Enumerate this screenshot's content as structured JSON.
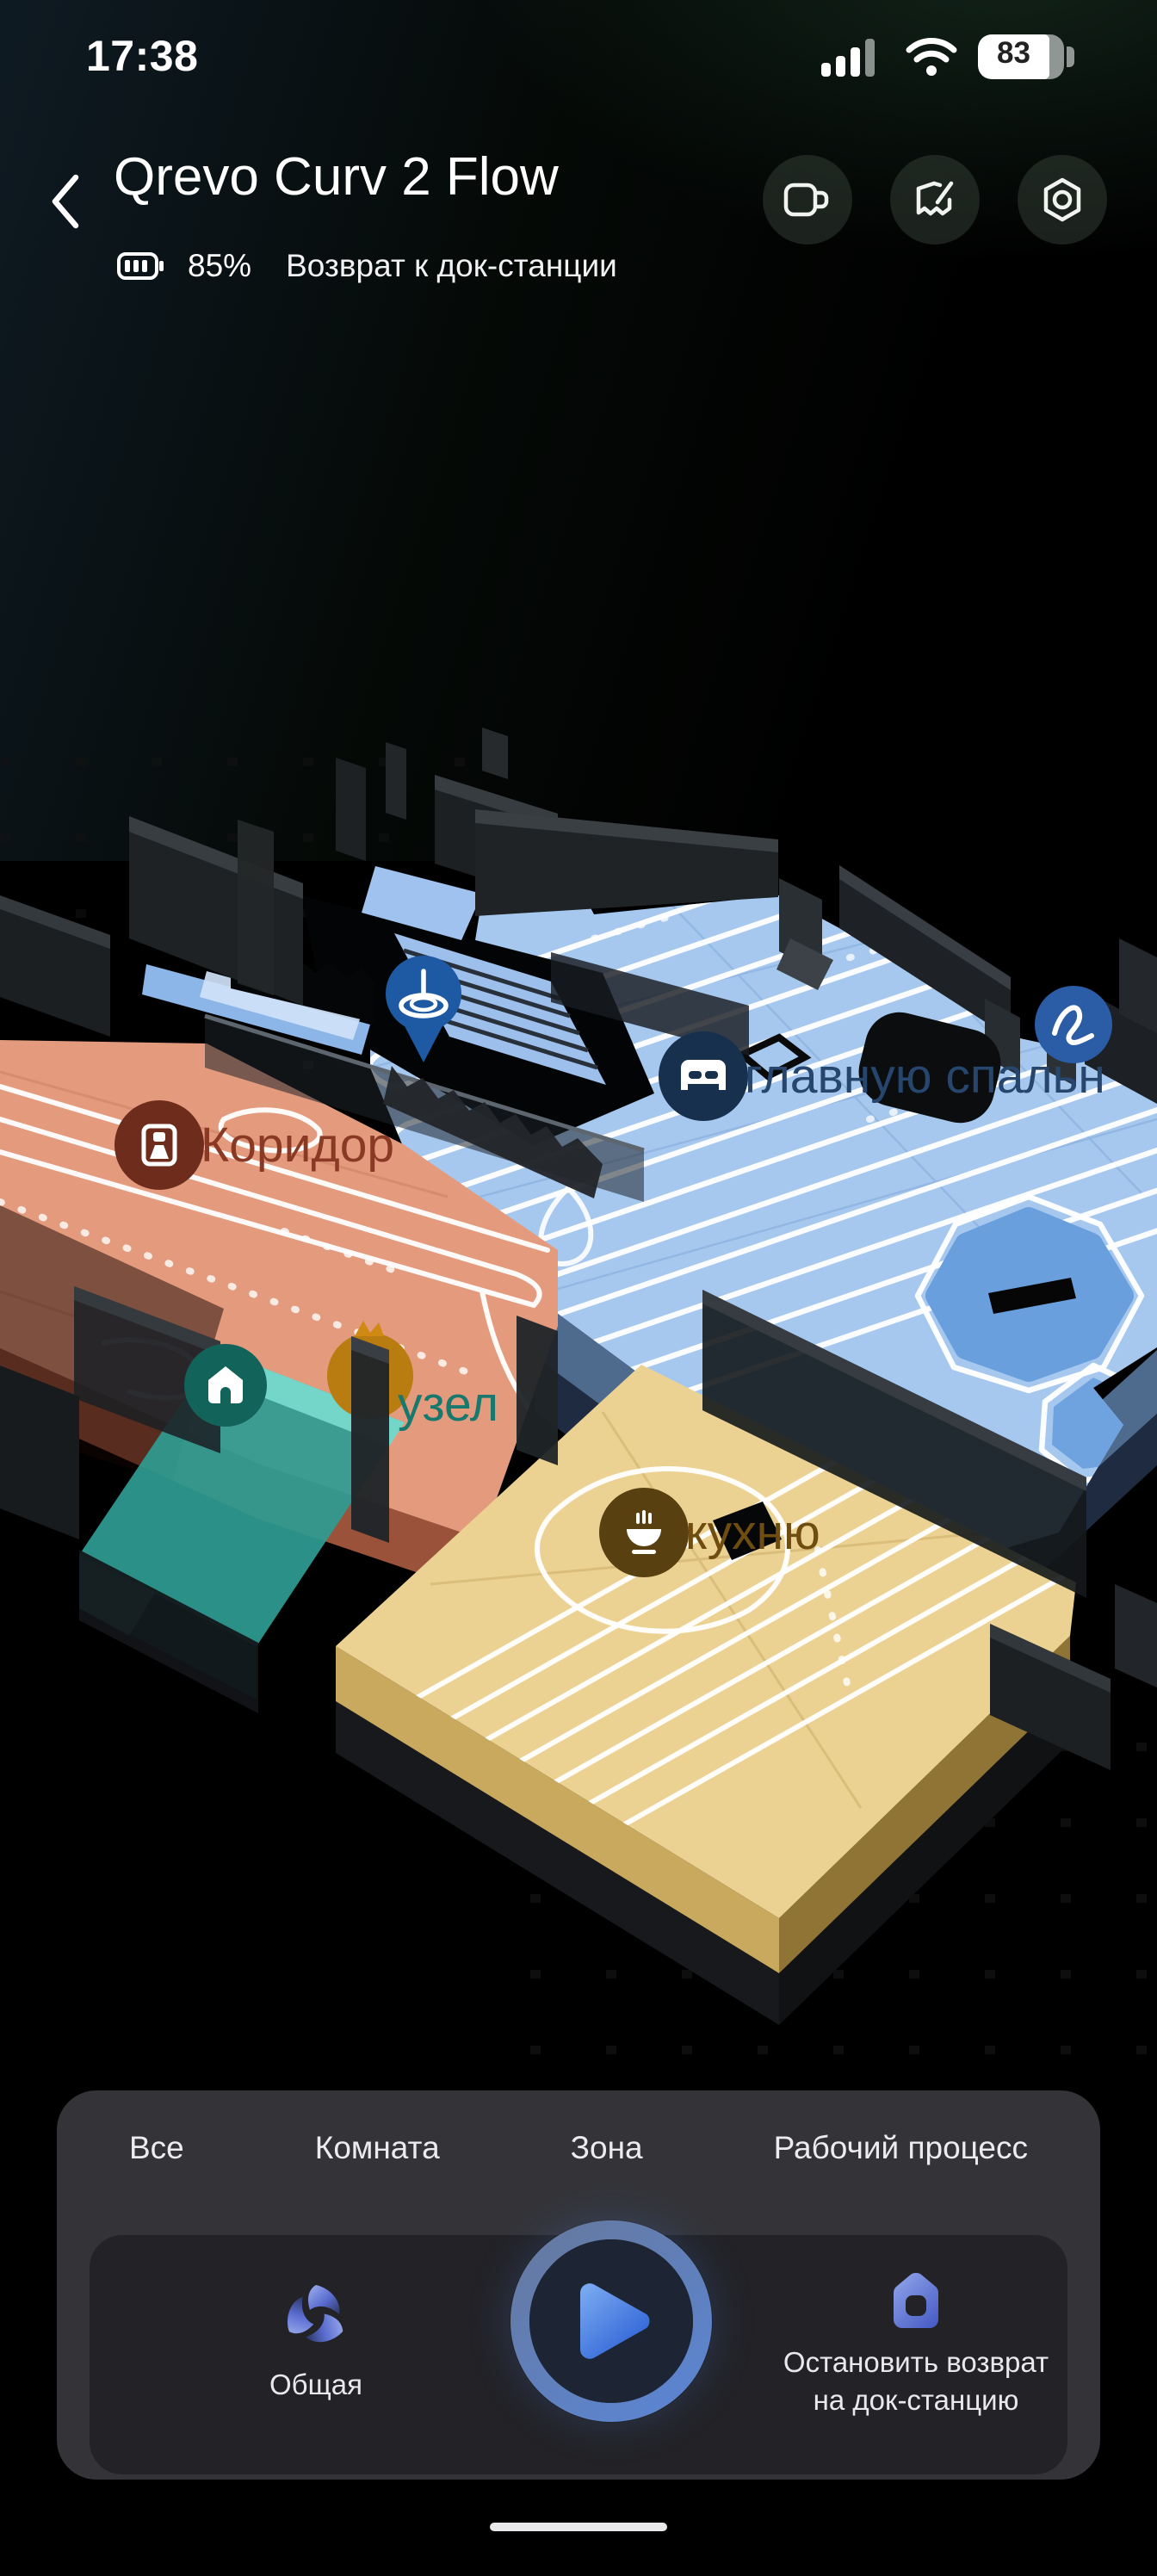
{
  "status_bar": {
    "time": "17:38",
    "battery_level": "83"
  },
  "header": {
    "title": "Qrevo Curv 2 Flow",
    "battery_percent": "85%",
    "status_text": "Возврат к док-станции",
    "action_icons": [
      "video-camera",
      "map-edit",
      "device-settings"
    ]
  },
  "map": {
    "labels": {
      "corridor": {
        "text": "Коридор",
        "icon": "door-icon",
        "badge_color": "#6e2c1d",
        "text_color": "#8a3a24"
      },
      "bedroom": {
        "text": "главную спальн",
        "icon": "bed-icon",
        "badge_color": "#16304e",
        "text_color": "#26466d"
      },
      "bathroom": {
        "text": "узел",
        "icon": "toilet-icon",
        "badge_color": "#b87c10",
        "text_color": "#17786d"
      },
      "kitchen": {
        "text": "кухню",
        "icon": "meal-icon",
        "badge_color": "#584010",
        "text_color": "#6f4d10"
      }
    },
    "markers": {
      "dock": {
        "icon": "home-icon",
        "color": "#12635a"
      },
      "position_pin": {
        "icon": "spinning-top-icon",
        "color": "#1e5aa4"
      },
      "scribble": {
        "icon": "scribble-icon",
        "color": "#2b5ca6"
      }
    },
    "room_colors": {
      "bedroom": "#a6c8ef",
      "corridor": "#e49a7c",
      "kitchen": "#ecd292",
      "dock_zone": "#2f9c92"
    }
  },
  "sheet": {
    "tabs": [
      {
        "label": "Все"
      },
      {
        "label": "Комната"
      },
      {
        "label": "Зона"
      },
      {
        "label": "Рабочий процесс"
      }
    ],
    "mode": {
      "label": "Общая",
      "icon": "swirl-icon"
    },
    "play": {
      "icon": "play-icon"
    },
    "stop": {
      "label_line1": "Остановить возврат",
      "label_line2": "на док-станцию",
      "icon": "dock-home-icon"
    }
  }
}
